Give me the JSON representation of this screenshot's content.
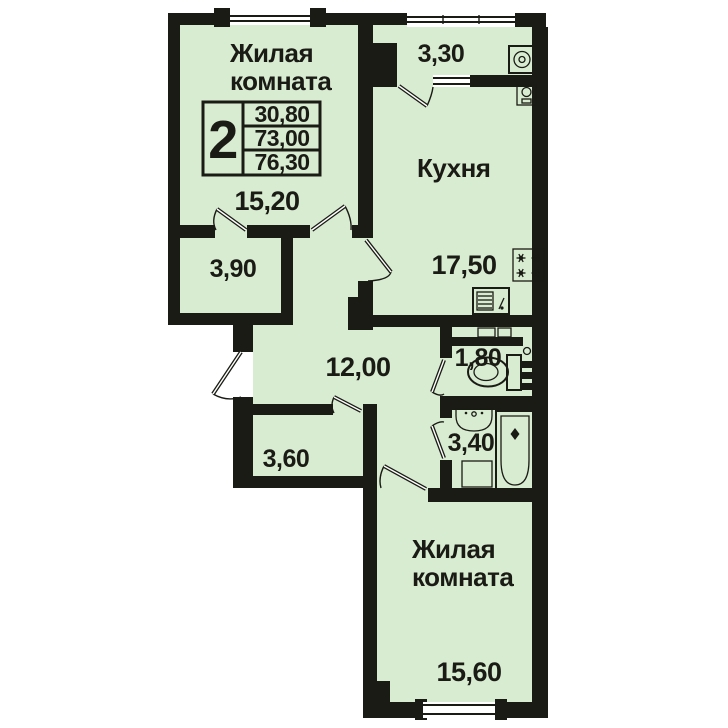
{
  "plan": {
    "title": "2-room apartment floor plan",
    "info_table": {
      "rooms_count": "2",
      "living_area": "30,80",
      "apartment_area": "73,00",
      "total_area": "76,30"
    },
    "rooms": [
      {
        "id": "living-top",
        "name_line1": "Жилая",
        "name_line2": "комната",
        "area": "15,20"
      },
      {
        "id": "balcony",
        "area": "3,30"
      },
      {
        "id": "kitchen",
        "name": "Кухня",
        "area": "17,50"
      },
      {
        "id": "storage",
        "area": "3,90"
      },
      {
        "id": "hall",
        "area": "12,00"
      },
      {
        "id": "wc",
        "area": "1,80"
      },
      {
        "id": "bathroom",
        "area": "3,40"
      },
      {
        "id": "closet",
        "area": "3,60"
      },
      {
        "id": "living-bottom",
        "name_line1": "Жилая",
        "name_line2": "комната",
        "area": "15,60"
      }
    ],
    "icons": [
      "washing-machine",
      "water-heater",
      "stove",
      "kitchen-sink",
      "toilet",
      "vent-shaft",
      "meter-boxes",
      "bath-sink",
      "bathtub",
      "appliance-spot"
    ],
    "colors": {
      "floor": "#d8ecd1",
      "wall": "#1b1b15",
      "text": "#1b1b15",
      "background": "#ffffff"
    }
  }
}
